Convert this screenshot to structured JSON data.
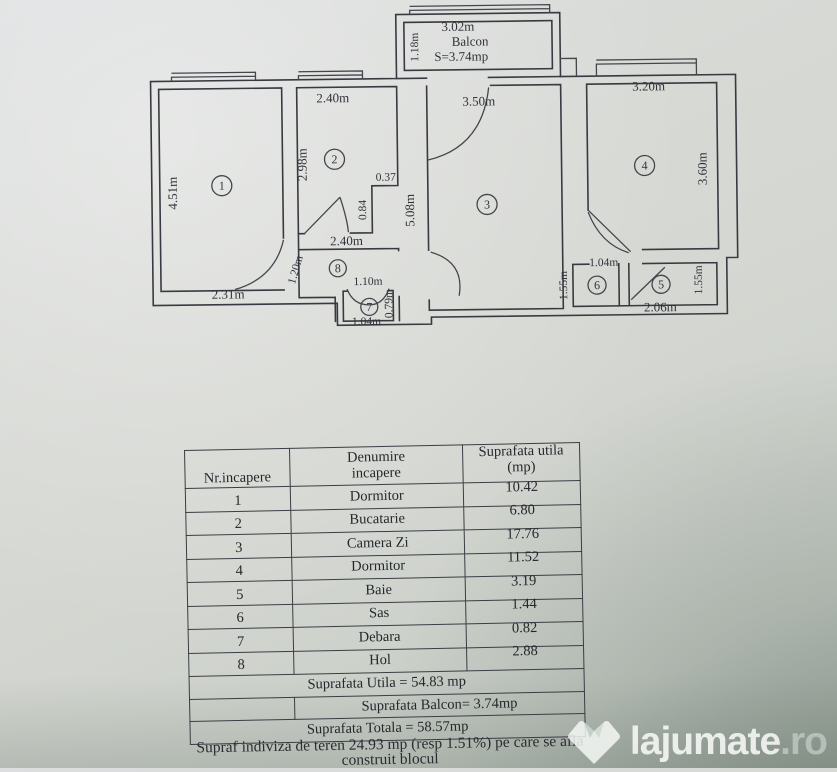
{
  "floorplan": {
    "balcony": {
      "width": "3.02m",
      "name": "Balcon",
      "area": "S=3.74mp",
      "depth": "1.18m"
    },
    "dims": {
      "room1_height": "4.51m",
      "room1_width": "2.31m",
      "room2_width": "2.40m",
      "room2_height": "2.98m",
      "notch_width": "0.37",
      "notch_height": "0.84",
      "hall_width": "2.40m",
      "hall_height": "1.20m",
      "room3_width": "3.50m",
      "room3_height": "5.08m",
      "room4_width": "3.20m",
      "room4_height": "3.60m",
      "room5_width": "2.06m",
      "room5_height": "1.55m",
      "room6_width": "1.04m",
      "room6_height": "1.55m",
      "room7_door": "1.10m",
      "room7_width": "1.04m",
      "room7_height": "0.79m"
    },
    "room_numbers": {
      "r1": "1",
      "r2": "2",
      "r3": "3",
      "r4": "4",
      "r5": "5",
      "r6": "6",
      "r7": "7",
      "r8": "8"
    }
  },
  "table": {
    "header": {
      "col1": "Nr.incapere",
      "col2_line1": "Denumire",
      "col2_line2": "incapere",
      "col3_line1": "Suprafata utila",
      "col3_line2": "(mp)"
    },
    "rows": [
      {
        "nr": "1",
        "name": "Dormitor",
        "area": "10.42"
      },
      {
        "nr": "2",
        "name": "Bucatarie",
        "area": "6.80"
      },
      {
        "nr": "3",
        "name": "Camera Zi",
        "area": "17.76"
      },
      {
        "nr": "4",
        "name": "Dormitor",
        "area": "11.52"
      },
      {
        "nr": "5",
        "name": "Baie",
        "area": "3.19"
      },
      {
        "nr": "6",
        "name": "Sas",
        "area": "1.44"
      },
      {
        "nr": "7",
        "name": "Debara",
        "area": "0.82"
      },
      {
        "nr": "8",
        "name": "Hol",
        "area": "2.88"
      }
    ],
    "summary": {
      "utila": "Suprafata Utila = 54.83 mp",
      "balcon": "Suprafata Balcon= 3.74mp",
      "totala": "Suprafata Totala = 58.57mp"
    }
  },
  "caption": {
    "line1": "Supraf indiviza de teren 24.93 mp (resp 1.51%) pe care se afla",
    "line2": "construit blocul"
  },
  "watermark": {
    "brand": "lajumate",
    "tld": ".ro"
  }
}
